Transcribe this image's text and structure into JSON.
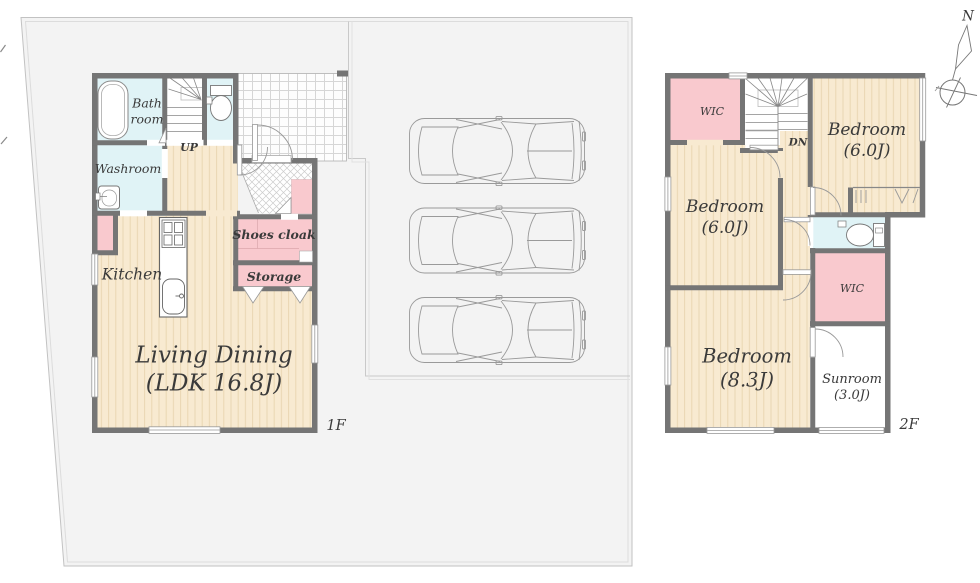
{
  "floor1": {
    "floor_label": "1F",
    "stairs_label": "UP",
    "rooms": {
      "bathroom": "Bath\nroom",
      "washroom": "Washroom",
      "kitchen": "Kitchen",
      "living_dining": "Living Dining\n(LDK 16.8J)",
      "shoes_cloak": "Shoes cloak",
      "storage": "Storage"
    }
  },
  "floor2": {
    "floor_label": "2F",
    "stairs_label": "DN",
    "rooms": {
      "wic_left": "WIC",
      "bedroom_northeast": "Bedroom\n(6.0J)",
      "bedroom_west": "Bedroom\n(6.0J)",
      "bedroom_south": "Bedroom\n(8.3J)",
      "wic_right": "WIC",
      "sunroom": "Sunroom\n(3.0J)"
    }
  },
  "compass": {
    "north_label": "N"
  },
  "parking": {
    "car_count": 3
  },
  "colors": {
    "site": "#f3f3f3",
    "wall": "#757575",
    "wood_floor": "#f8ead1",
    "wet_area": "#e0f3f6",
    "closet_pink": "#f9c9ce",
    "line_gray": "#999999"
  }
}
